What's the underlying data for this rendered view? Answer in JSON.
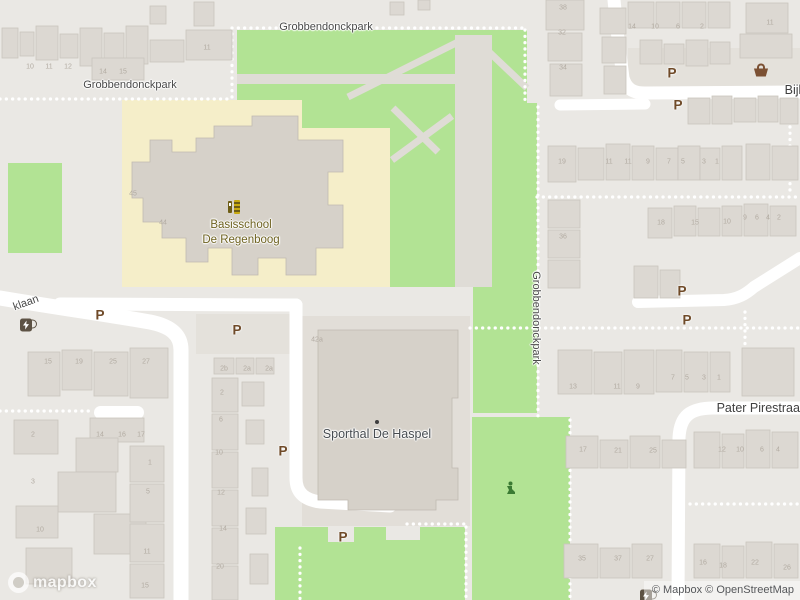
{
  "colors": {
    "bg": "#eae8e4",
    "park": "#b2e394",
    "school_ground": "#f5eec9",
    "road": "#ffffff",
    "building": "#dcd8d2",
    "building_dark": "#d6d1c9",
    "path_gray": "#dfdcd6",
    "parking_brown": "#6f4a28",
    "label_gray": "#4a4a4a",
    "poi_school_color": "#6e6220",
    "poi_sport_color": "#474c51",
    "house_number_color": "#b2aba2"
  },
  "map": {
    "logo_text": "mapbox",
    "attribution": "© Mapbox © OpenStreetMap",
    "parking_label": "P",
    "street_labels": [
      {
        "text": "Grobbendonckpark",
        "x": 326,
        "y": 27,
        "rot": 0,
        "cls": "street"
      },
      {
        "text": "Grobbendonckpark",
        "x": 130,
        "y": 85,
        "rot": 0,
        "cls": "street"
      },
      {
        "text": "Grobbendonckpark",
        "x": 536,
        "y": 318,
        "rot": 90,
        "cls": "street"
      },
      {
        "text": "Pater Pirestraat",
        "x": 760,
        "y": 408,
        "rot": 0,
        "cls": "street-lg"
      },
      {
        "text": "Bijl",
        "x": 793,
        "y": 90,
        "rot": 0,
        "cls": "street-lg"
      },
      {
        "text": "klaan",
        "x": 26,
        "y": 303,
        "rot": -20,
        "cls": "street"
      }
    ],
    "poi_labels": [
      {
        "text": "Basisschool\nDe Regenboog",
        "x": 241,
        "y": 233,
        "cls": "poi-school",
        "name": "poi-label-basisschool-de-regenboog"
      },
      {
        "text": "Sporthal De Haspel",
        "x": 377,
        "y": 434,
        "cls": "poi-sport",
        "name": "poi-label-sporthal-de-haspel"
      }
    ],
    "parking_markers": [
      {
        "x": 672,
        "y": 73
      },
      {
        "x": 678,
        "y": 105
      },
      {
        "x": 100,
        "y": 315
      },
      {
        "x": 237,
        "y": 330
      },
      {
        "x": 682,
        "y": 291
      },
      {
        "x": 687,
        "y": 320
      },
      {
        "x": 283,
        "y": 451
      },
      {
        "x": 343,
        "y": 537
      }
    ],
    "icons": [
      {
        "type": "school",
        "x": 234,
        "y": 207
      },
      {
        "type": "basket",
        "x": 761,
        "y": 70
      },
      {
        "type": "ev",
        "x": 26,
        "y": 325
      },
      {
        "type": "ev",
        "x": 646,
        "y": 596
      },
      {
        "type": "playground",
        "x": 511,
        "y": 488
      },
      {
        "type": "dot",
        "x": 377,
        "y": 422
      }
    ],
    "house_numbers": [
      {
        "t": "10",
        "x": 30,
        "y": 67
      },
      {
        "t": "11",
        "x": 49,
        "y": 67
      },
      {
        "t": "12",
        "x": 68,
        "y": 67
      },
      {
        "t": "14",
        "x": 103,
        "y": 72
      },
      {
        "t": "15",
        "x": 123,
        "y": 72
      },
      {
        "t": "11",
        "x": 207,
        "y": 48
      },
      {
        "t": "14",
        "x": 632,
        "y": 27
      },
      {
        "t": "10",
        "x": 655,
        "y": 27
      },
      {
        "t": "6",
        "x": 678,
        "y": 27
      },
      {
        "t": "2",
        "x": 702,
        "y": 27
      },
      {
        "t": "11",
        "x": 770,
        "y": 23
      },
      {
        "t": "38",
        "x": 563,
        "y": 8
      },
      {
        "t": "32",
        "x": 562,
        "y": 33
      },
      {
        "t": "34",
        "x": 563,
        "y": 68
      },
      {
        "t": "36",
        "x": 563,
        "y": 237
      },
      {
        "t": "19",
        "x": 562,
        "y": 162
      },
      {
        "t": "11",
        "x": 609,
        "y": 162
      },
      {
        "t": "11",
        "x": 628,
        "y": 162
      },
      {
        "t": "9",
        "x": 648,
        "y": 162
      },
      {
        "t": "7",
        "x": 669,
        "y": 162
      },
      {
        "t": "5",
        "x": 683,
        "y": 162
      },
      {
        "t": "3",
        "x": 704,
        "y": 162
      },
      {
        "t": "1",
        "x": 717,
        "y": 162
      },
      {
        "t": "9",
        "x": 745,
        "y": 218
      },
      {
        "t": "6",
        "x": 757,
        "y": 218
      },
      {
        "t": "4",
        "x": 768,
        "y": 218
      },
      {
        "t": "2",
        "x": 779,
        "y": 218
      },
      {
        "t": "18",
        "x": 661,
        "y": 223
      },
      {
        "t": "15",
        "x": 695,
        "y": 223
      },
      {
        "t": "10",
        "x": 727,
        "y": 222
      },
      {
        "t": "45",
        "x": 133,
        "y": 194
      },
      {
        "t": "44",
        "x": 163,
        "y": 223
      },
      {
        "t": "42a",
        "x": 317,
        "y": 340
      },
      {
        "t": "7",
        "x": 673,
        "y": 378
      },
      {
        "t": "5",
        "x": 687,
        "y": 378
      },
      {
        "t": "3",
        "x": 704,
        "y": 378
      },
      {
        "t": "1",
        "x": 719,
        "y": 378
      },
      {
        "t": "13",
        "x": 573,
        "y": 387
      },
      {
        "t": "11",
        "x": 617,
        "y": 387
      },
      {
        "t": "9",
        "x": 638,
        "y": 387
      },
      {
        "t": "17",
        "x": 583,
        "y": 450
      },
      {
        "t": "21",
        "x": 618,
        "y": 451
      },
      {
        "t": "25",
        "x": 653,
        "y": 451
      },
      {
        "t": "12",
        "x": 722,
        "y": 450
      },
      {
        "t": "10",
        "x": 740,
        "y": 450
      },
      {
        "t": "6",
        "x": 762,
        "y": 450
      },
      {
        "t": "4",
        "x": 778,
        "y": 450
      },
      {
        "t": "35",
        "x": 582,
        "y": 559
      },
      {
        "t": "37",
        "x": 618,
        "y": 559
      },
      {
        "t": "27",
        "x": 650,
        "y": 559
      },
      {
        "t": "16",
        "x": 703,
        "y": 563
      },
      {
        "t": "18",
        "x": 723,
        "y": 566
      },
      {
        "t": "22",
        "x": 755,
        "y": 563
      },
      {
        "t": "26",
        "x": 787,
        "y": 568
      },
      {
        "t": "15",
        "x": 48,
        "y": 362
      },
      {
        "t": "19",
        "x": 79,
        "y": 362
      },
      {
        "t": "25",
        "x": 113,
        "y": 362
      },
      {
        "t": "27",
        "x": 146,
        "y": 362
      },
      {
        "t": "2",
        "x": 33,
        "y": 435
      },
      {
        "t": "14",
        "x": 100,
        "y": 435
      },
      {
        "t": "16",
        "x": 122,
        "y": 435
      },
      {
        "t": "17",
        "x": 141,
        "y": 435
      },
      {
        "t": "1",
        "x": 150,
        "y": 463
      },
      {
        "t": "3",
        "x": 33,
        "y": 482
      },
      {
        "t": "5",
        "x": 148,
        "y": 492
      },
      {
        "t": "10",
        "x": 40,
        "y": 530
      },
      {
        "t": "11",
        "x": 147,
        "y": 552
      },
      {
        "t": "15",
        "x": 145,
        "y": 586
      },
      {
        "t": "2b",
        "x": 224,
        "y": 369
      },
      {
        "t": "2a",
        "x": 247,
        "y": 369
      },
      {
        "t": "2a",
        "x": 269,
        "y": 369
      },
      {
        "t": "2",
        "x": 222,
        "y": 393
      },
      {
        "t": "6",
        "x": 221,
        "y": 420
      },
      {
        "t": "10",
        "x": 219,
        "y": 453
      },
      {
        "t": "12",
        "x": 221,
        "y": 493
      },
      {
        "t": "14",
        "x": 223,
        "y": 529
      },
      {
        "t": "20",
        "x": 220,
        "y": 567
      }
    ]
  }
}
